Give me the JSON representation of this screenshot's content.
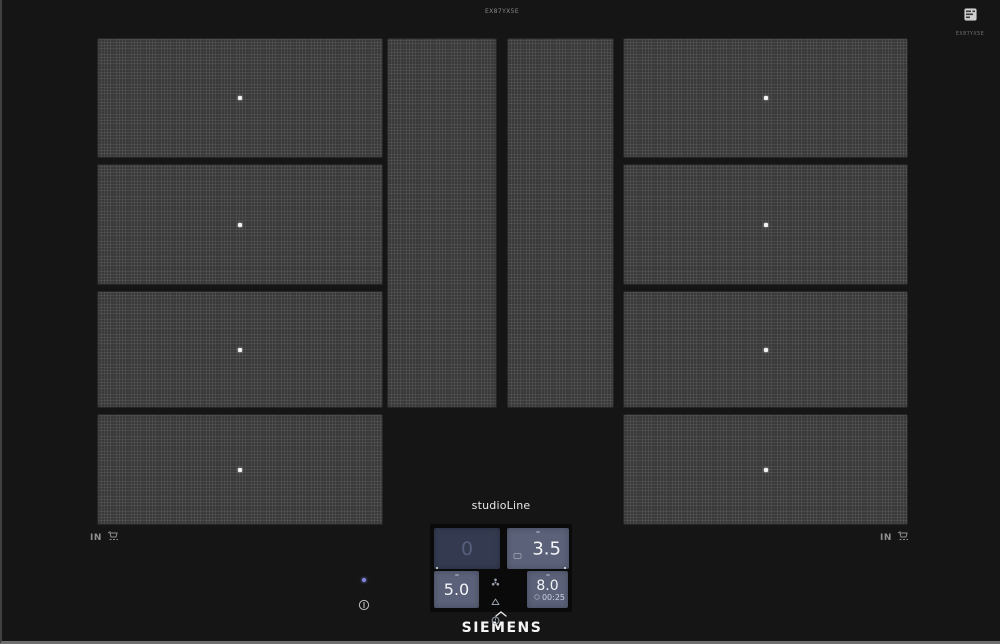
{
  "header": {
    "model_label": "EX87YX5E",
    "energy_label_code": "EX87YX5E"
  },
  "branding": {
    "series": "studioLine",
    "logo": "SIEMENS"
  },
  "markings": {
    "induction_left": "IN",
    "induction_right": "IN"
  },
  "control_panel": {
    "display_top_left": {
      "value": "0",
      "state": "inactive"
    },
    "display_top_right": {
      "value": "3.5",
      "state": "active"
    },
    "display_bottom_left": {
      "value": "5.0",
      "state": "active"
    },
    "display_bottom_right": {
      "value": "8.0",
      "timer": "00:25",
      "state": "active"
    }
  },
  "zones": {
    "left_count": 4,
    "right_count": 4,
    "center_strips": 2
  },
  "colors": {
    "display_active_bg": "#5a6178",
    "display_inactive_bg": "#343b50",
    "led_indicator": "#8286e0",
    "zone_base": "#3a3a3a",
    "glass": "#151515"
  }
}
